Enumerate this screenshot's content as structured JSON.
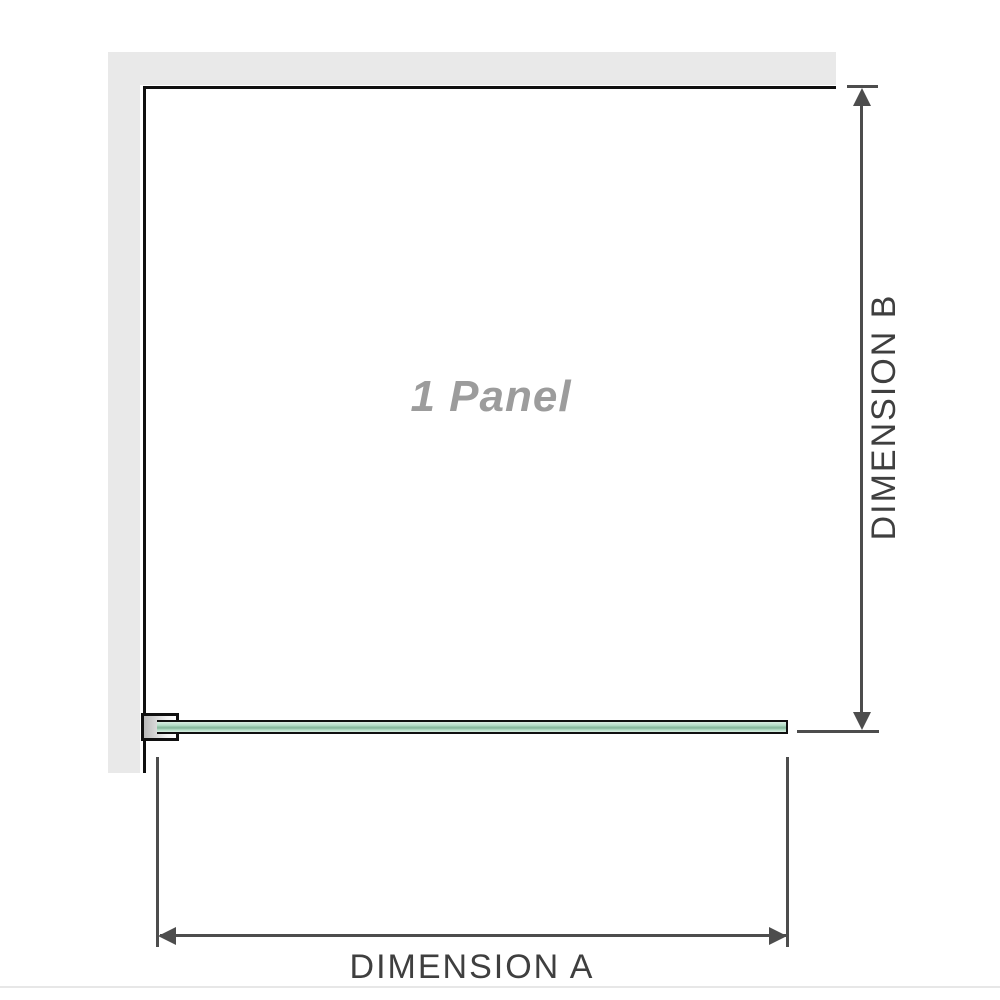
{
  "diagram": {
    "panel_label": "1 Panel",
    "dimension_a_label": "DIMENSION A",
    "dimension_b_label": "DIMENSION B"
  },
  "colors": {
    "wall_color": "#e9e9e9",
    "outline_color": "#101010",
    "dim_color": "#4d4d4d",
    "dim_text_color": "#3f3f3f",
    "panel_text_color": "#9c9c9c",
    "glass_top": "#d9eee2",
    "glass_mid": "#b2dcc5",
    "glass_line": "#8abba0",
    "bracket_dark": "#b9b9b9",
    "bracket_light": "#f2f2f2",
    "divider_color": "#e7e7e7"
  }
}
